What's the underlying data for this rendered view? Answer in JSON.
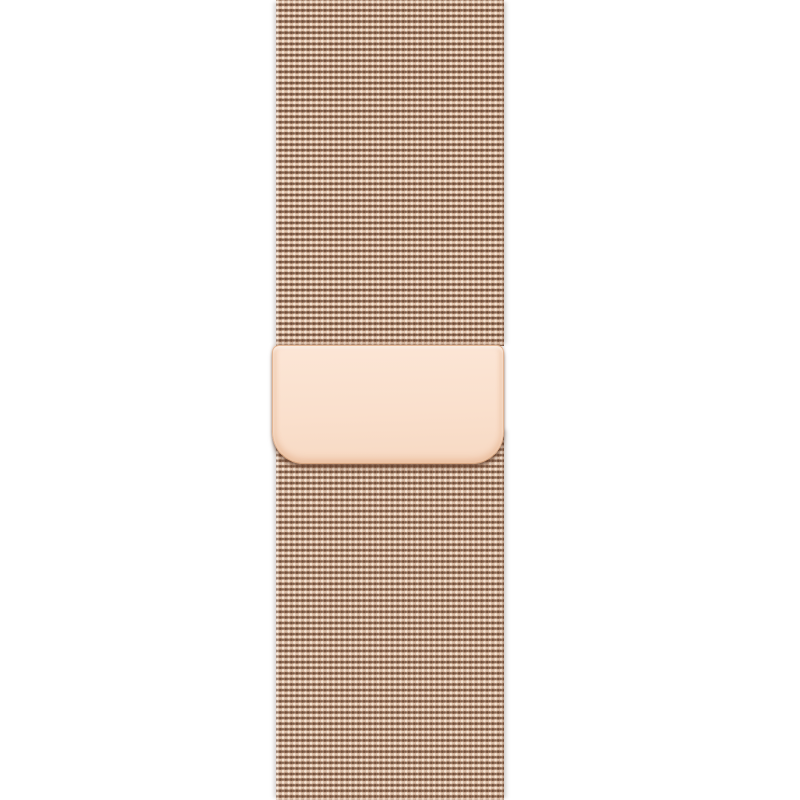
{
  "scene": {
    "description": "Product photo of a gold milanese-loop style watch band: woven metal mesh strap with a smooth rounded magnetic clasp plate in the middle, on a white background",
    "elements": {
      "upper_strap": "woven gold metal mesh strap segment",
      "clasp": "smooth polished gold magnetic clasp plate with rounded bottom corners",
      "lower_strap": "woven gold metal mesh strap segment continuing behind the clasp"
    },
    "colors": {
      "background": "#ffffff",
      "mesh-base": "#c59c7f",
      "mesh-highlight": "#f7e6d5",
      "mesh-dark": "#6b4a37",
      "mesh-edge-haze": "#d9d4cf",
      "clasp-top": "#fce6d6",
      "clasp-mid": "#fae0cd",
      "clasp-bottom": "#f7d9c3",
      "clasp-border": "#e3b592",
      "clasp-under-shadow": "#64402c"
    }
  }
}
